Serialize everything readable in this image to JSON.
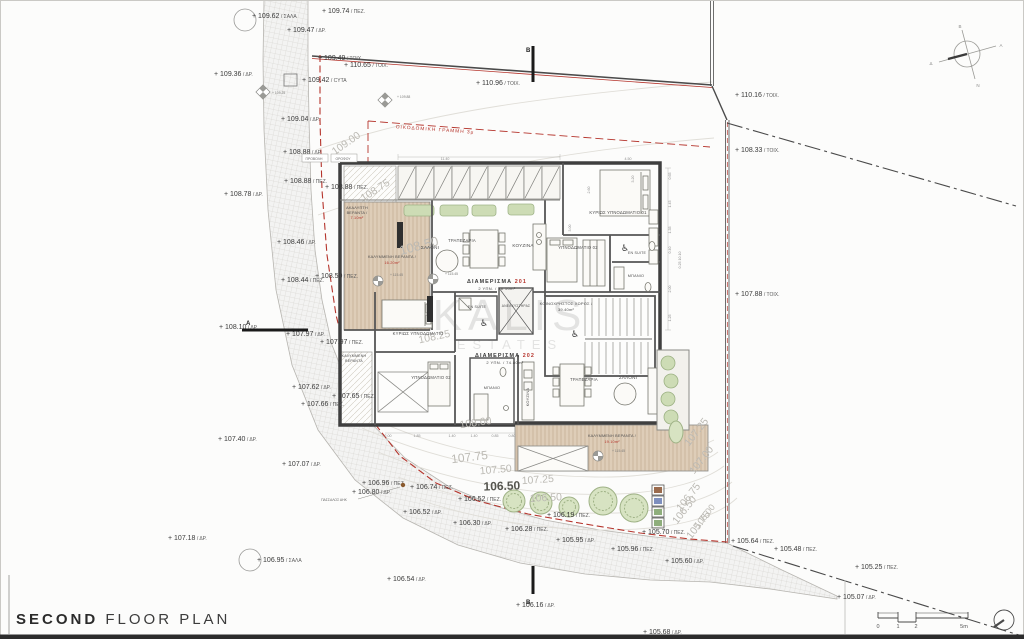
{
  "title": {
    "bold": "SECOND",
    "rest": " FLOOR PLAN"
  },
  "watermark": {
    "l1": "KALIS",
    "l2": "ESTATES"
  },
  "colors": {
    "red": "#b5342c",
    "wall": "#3f3f3f",
    "road_fill": "#ecebe7",
    "deck": "#decdb8",
    "green": "#cddcb5",
    "contour_text": "#bcbab4"
  },
  "markers": [
    {
      "x": 252,
      "y": 18,
      "v": "109.62",
      "s": "ΣΑΛΑ",
      "circle": [
        245,
        20,
        11
      ]
    },
    {
      "x": 322,
      "y": 13,
      "v": "109.74",
      "s": "ΠΕΖ."
    },
    {
      "x": 287,
      "y": 32,
      "v": "109.47",
      "s": "ΔΡ."
    },
    {
      "x": 318,
      "y": 60,
      "v": "109.49",
      "s": "ΤΟΙΧ."
    },
    {
      "x": 344,
      "y": 67,
      "v": "110.65",
      "s": "ΤΟΙΧ."
    },
    {
      "x": 214,
      "y": 76,
      "v": "109.36",
      "s": "ΔΡ."
    },
    {
      "x": 302,
      "y": 82,
      "v": "109.42",
      "s": "CYTA",
      "box": [
        284,
        74,
        13,
        12
      ]
    },
    {
      "x": 476,
      "y": 85,
      "v": "110.96",
      "s": "ΤΟΙΧ."
    },
    {
      "x": 735,
      "y": 97,
      "v": "110.16",
      "s": "ΤΟΙΧ."
    },
    {
      "x": 281,
      "y": 121,
      "v": "109.04",
      "s": "ΔΡ."
    },
    {
      "x": 735,
      "y": 152,
      "v": "108.33",
      "s": "ΤΟΙΧ."
    },
    {
      "x": 283,
      "y": 154,
      "v": "108.88",
      "s": "ΔΡ."
    },
    {
      "x": 224,
      "y": 196,
      "v": "108.78",
      "s": "ΔΡ."
    },
    {
      "x": 284,
      "y": 183,
      "v": "108.88",
      "s": "ΠΕΖ."
    },
    {
      "x": 325,
      "y": 189,
      "v": "108.88",
      "s": "ΠΕΖ."
    },
    {
      "x": 277,
      "y": 244,
      "v": "108.46",
      "s": "ΔΡ."
    },
    {
      "x": 735,
      "y": 296,
      "v": "107.88",
      "s": "ΤΟΙΧ."
    },
    {
      "x": 281,
      "y": 282,
      "v": "108.44",
      "s": "ΠΕΖ."
    },
    {
      "x": 315,
      "y": 278,
      "v": "108.50",
      "s": "ΠΕΖ."
    },
    {
      "x": 219,
      "y": 329,
      "v": "108.10",
      "s": "ΔΡ."
    },
    {
      "x": 286,
      "y": 336,
      "v": "107.97",
      "s": "ΔΡ."
    },
    {
      "x": 320,
      "y": 344,
      "v": "107.97",
      "s": "ΠΕΖ."
    },
    {
      "x": 292,
      "y": 389,
      "v": "107.62",
      "s": "ΔΡ."
    },
    {
      "x": 332,
      "y": 398,
      "v": "107.65",
      "s": "ΠΕΖ."
    },
    {
      "x": 301,
      "y": 406,
      "v": "107.66",
      "s": "ΠΕΖ."
    },
    {
      "x": 218,
      "y": 441,
      "v": "107.40",
      "s": "ΔΡ."
    },
    {
      "x": 282,
      "y": 466,
      "v": "107.07",
      "s": "ΔΡ."
    },
    {
      "x": 362,
      "y": 485,
      "v": "106.96",
      "s": "ΠΕΖ."
    },
    {
      "x": 352,
      "y": 494,
      "v": "106.80",
      "s": "ΔΡ."
    },
    {
      "x": 168,
      "y": 540,
      "v": "107.18",
      "s": "ΔΡ."
    },
    {
      "x": 257,
      "y": 562,
      "v": "106.95",
      "s": "ΣΑΛΑ",
      "circle": [
        250,
        560,
        11
      ]
    },
    {
      "x": 410,
      "y": 489,
      "v": "106.74",
      "s": "ΠΕΖ.",
      "dot": [
        403,
        485
      ]
    },
    {
      "x": 458,
      "y": 501,
      "v": "106.52",
      "s": "ΠΕΖ."
    },
    {
      "x": 403,
      "y": 514,
      "v": "106.52",
      "s": "ΔΡ."
    },
    {
      "x": 453,
      "y": 525,
      "v": "106.30",
      "s": "ΔΡ."
    },
    {
      "x": 505,
      "y": 531,
      "v": "106.28",
      "s": "ΠΕΖ."
    },
    {
      "x": 547,
      "y": 517,
      "v": "106.19",
      "s": "ΠΕΖ."
    },
    {
      "x": 556,
      "y": 542,
      "v": "105.95",
      "s": "ΔΡ."
    },
    {
      "x": 611,
      "y": 551,
      "v": "105.96",
      "s": "ΠΕΖ."
    },
    {
      "x": 642,
      "y": 534,
      "v": "105.70",
      "s": "ΠΕΖ."
    },
    {
      "x": 665,
      "y": 563,
      "v": "105.60",
      "s": "ΔΡ."
    },
    {
      "x": 387,
      "y": 581,
      "v": "106.54",
      "s": "ΔΡ."
    },
    {
      "x": 516,
      "y": 607,
      "v": "106.16",
      "s": "ΔΡ."
    },
    {
      "x": 643,
      "y": 634,
      "v": "105.68",
      "s": "ΔΡ."
    },
    {
      "x": 731,
      "y": 543,
      "v": "105.64",
      "s": "ΠΕΖ."
    },
    {
      "x": 774,
      "y": 551,
      "v": "105.48",
      "s": "ΠΕΖ."
    },
    {
      "x": 855,
      "y": 569,
      "v": "105.25",
      "s": "ΠΕΖ."
    },
    {
      "x": 837,
      "y": 599,
      "v": "105.07",
      "s": "ΔΡ."
    }
  ],
  "contours": [
    {
      "x": 348,
      "y": 146,
      "r": -35,
      "t": "109.00"
    },
    {
      "x": 377,
      "y": 193,
      "r": -33,
      "t": "108.75"
    },
    {
      "x": 420,
      "y": 250,
      "r": -15,
      "t": "108.50",
      "fs": 13
    },
    {
      "x": 435,
      "y": 340,
      "r": -12,
      "t": "108.25"
    },
    {
      "x": 476,
      "y": 426,
      "r": -8,
      "t": "108.00"
    },
    {
      "x": 470,
      "y": 461,
      "r": -7,
      "t": "107.75",
      "fs": 12
    },
    {
      "x": 496,
      "y": 473,
      "r": -5,
      "t": "107.50"
    },
    {
      "x": 538,
      "y": 483,
      "r": -4,
      "t": "107.25"
    },
    {
      "x": 502,
      "y": 490,
      "r": -2,
      "t": "106.50",
      "b": 1,
      "fs": 12
    },
    {
      "x": 546,
      "y": 501,
      "r": -3,
      "t": "106.50"
    },
    {
      "x": 699,
      "y": 434,
      "r": -52,
      "t": "107.25"
    },
    {
      "x": 704,
      "y": 462,
      "r": -52,
      "t": "107.00"
    },
    {
      "x": 691,
      "y": 499,
      "r": -52,
      "t": "106.75"
    },
    {
      "x": 687,
      "y": 512,
      "r": -52,
      "t": "106.50"
    },
    {
      "x": 707,
      "y": 518,
      "r": -52,
      "t": "106.00",
      "fs": 9
    },
    {
      "x": 701,
      "y": 527,
      "r": -52,
      "t": "105.75"
    }
  ],
  "rooms": [
    {
      "x": 357,
      "y": 209,
      "t": "ΑΚΑΛΥΠΤΗ",
      "fs": 3.8
    },
    {
      "x": 357,
      "y": 214,
      "t": "ΒΕΡΑΝΤΑ /",
      "fs": 3.8
    },
    {
      "x": 357,
      "y": 219,
      "t": "7.10m²",
      "fs": 3.8,
      "red": 1
    },
    {
      "x": 392,
      "y": 258,
      "t": "ΚΑΛΥΜΜΕΝΗ ΒΕΡΑΝΤΑ /",
      "fs": 3.8
    },
    {
      "x": 392,
      "y": 264,
      "t": "16.20m²",
      "fs": 3.8,
      "red": 1
    },
    {
      "x": 430,
      "y": 249,
      "t": "ΣΑΛΟΝΙ"
    },
    {
      "x": 462,
      "y": 242,
      "t": "ΤΡΑΠΕΖΑΡΙΑ",
      "fs": 4.2
    },
    {
      "x": 523,
      "y": 247,
      "t": "ΚΟΥΖΙΝΑ"
    },
    {
      "x": 618,
      "y": 214,
      "t": "ΚΥΡΙΩΣ ΥΠΝΟΔΩΜΑΤΙΟ 01",
      "fs": 4.2
    },
    {
      "x": 578,
      "y": 249,
      "t": "ΥΠΝΟΔΩΜΑΤΙΟ 02",
      "fs": 4.2
    },
    {
      "x": 637,
      "y": 254,
      "t": "EN SUITE",
      "fs": 3.6
    },
    {
      "x": 636,
      "y": 277,
      "t": "ΜΠΑΝΙΟ",
      "fs": 3.8
    },
    {
      "x": 566,
      "y": 305,
      "t": "ΚΟΙΝΟΧΡΗΣΤΟΣ ΧΩΡΟΣ /",
      "fs": 4
    },
    {
      "x": 566,
      "y": 311,
      "t": "39.40m²",
      "fs": 4
    },
    {
      "x": 516,
      "y": 307,
      "t": "ΑΝΕΛΚΥΣΤΗΡΑΣ",
      "fs": 3.3
    },
    {
      "x": 477,
      "y": 308,
      "t": "EN SUITE",
      "fs": 3.6
    },
    {
      "x": 418,
      "y": 335,
      "t": "ΚΥΡΙΩΣ ΥΠΝΟΔΩΜΑΤΙΟ",
      "fs": 4.2
    },
    {
      "x": 431,
      "y": 379,
      "t": "ΥΠΝΟΔΩΜΑΤΙΟ 02",
      "fs": 4.2
    },
    {
      "x": 492,
      "y": 389,
      "t": "ΜΠΑΝΙΟ",
      "fs": 3.8
    },
    {
      "x": 529,
      "y": 397,
      "t": "ΚΟΥΖΙΝΑ",
      "rot": -90,
      "fs": 4
    },
    {
      "x": 584,
      "y": 381,
      "t": "ΤΡΑΠΕΖΑΡΙΑ",
      "fs": 4.2
    },
    {
      "x": 628,
      "y": 379,
      "t": "ΣΑΛΟΝΙ"
    },
    {
      "x": 354,
      "y": 357,
      "t": "ΚΑΛΥΜΜΕΝΗ",
      "fs": 3.6
    },
    {
      "x": 354,
      "y": 362,
      "t": "ΒΕΡΑΝΤΑ",
      "fs": 3.6
    },
    {
      "x": 612,
      "y": 437,
      "t": "ΚΑΛΥΜΜΕΝΗ ΒΕΡΑΝΤΑ /",
      "fs": 3.8
    },
    {
      "x": 612,
      "y": 443,
      "t": "19.10m²",
      "fs": 3.8,
      "red": 1
    }
  ],
  "apartments": [
    {
      "x": 497,
      "y": 283,
      "name": "ΔΙΑΜΕΡΙΣΜΑ ",
      "num": "201",
      "sub": "2 ΥΠΝ. / 76.10m²",
      "suby": 290
    },
    {
      "x": 505,
      "y": 357,
      "name": "ΔΙΑΜΕΡΙΣΜΑ ",
      "num": "202",
      "sub": "2 ΥΠΝ. / 74.80m²",
      "suby": 364
    }
  ],
  "dims": [
    {
      "t": "11.40",
      "x": 445,
      "y": 160
    },
    {
      "t": "4.50",
      "x": 628,
      "y": 160
    },
    {
      "t": "3.20",
      "x": 634,
      "y": 179,
      "r": -90
    },
    {
      "t": "2.60",
      "x": 590,
      "y": 190,
      "r": -90
    },
    {
      "t": "3.00",
      "x": 571,
      "y": 228,
      "r": -90
    },
    {
      "t": "0.65",
      "x": 671,
      "y": 176,
      "r": -90
    },
    {
      "t": "1.45",
      "x": 671,
      "y": 204,
      "r": -90
    },
    {
      "t": "1.35",
      "x": 671,
      "y": 230,
      "r": -90
    },
    {
      "t": "0.40",
      "x": 671,
      "y": 250,
      "r": -90
    },
    {
      "t": "2.00",
      "x": 671,
      "y": 289,
      "r": -90
    },
    {
      "t": "1.25",
      "x": 671,
      "y": 318,
      "r": -90
    },
    {
      "t": "0.25 10.10",
      "x": 681,
      "y": 260,
      "r": -90
    },
    {
      "t": "2.00",
      "x": 388,
      "y": 437
    },
    {
      "t": "1.85",
      "x": 417,
      "y": 437
    },
    {
      "t": "1.40",
      "x": 452,
      "y": 437
    },
    {
      "t": "1.40",
      "x": 474,
      "y": 437
    },
    {
      "t": "0.85",
      "x": 495,
      "y": 437
    },
    {
      "t": "0.80",
      "x": 512,
      "y": 437
    }
  ],
  "tiny_levels": [
    {
      "x": 272,
      "y": 94,
      "t": "+ 109.25"
    },
    {
      "x": 397,
      "y": 98,
      "t": "+ 109.88"
    },
    {
      "x": 390,
      "y": 276,
      "t": "+ 115.45"
    },
    {
      "x": 445,
      "y": 275,
      "t": "+ 115.45"
    },
    {
      "x": 612,
      "y": 452,
      "t": "+ 115.45"
    }
  ],
  "sections": [
    {
      "t": "A",
      "tx": 246,
      "ty": 325,
      "bar": [
        242,
        330,
        308,
        330
      ]
    },
    {
      "t": "B",
      "tx": 526,
      "ty": 52,
      "bar": [
        533,
        46,
        533,
        82
      ]
    },
    {
      "t": "B",
      "tx": 526,
      "ty": 604,
      "bar": [
        533,
        566,
        533,
        594
      ]
    }
  ],
  "annotations": {
    "building_line": {
      "t": "ΟΙΚΟΔΟΜΙΚΗ ΓΡΑΜΜΗ 3μ",
      "x": 435,
      "y": 131,
      "rot": 4
    },
    "projection": [
      {
        "t": "ΠΡΟΒΟΛΗ",
        "x": 314,
        "y": 160,
        "bx": 302
      },
      {
        "t": "ΟΡΟΦΟΥ",
        "x": 343,
        "y": 160,
        "bx": 331
      }
    ],
    "pole": {
      "t": "ΠΑΣΣΑΛΟΣ ΑΗΚ",
      "x": 334,
      "y": 501
    }
  },
  "compass": {
    "letters": [
      {
        "t": "Β",
        "x": 960,
        "y": 28
      },
      {
        "t": "Ν",
        "x": 978,
        "y": 87
      },
      {
        "t": "Α",
        "x": 1001,
        "y": 47
      },
      {
        "t": "Δ",
        "x": 931,
        "y": 65
      }
    ]
  },
  "scalebar": {
    "labels": [
      {
        "t": "0",
        "x": 878
      },
      {
        "t": "1",
        "x": 898
      },
      {
        "t": "2",
        "x": 916
      },
      {
        "t": "5m",
        "x": 964
      }
    ],
    "y": 628
  },
  "legend_colors": [
    "#9a6a4c",
    "#7e8fbe",
    "#8fae7c",
    "#8fae7c"
  ]
}
